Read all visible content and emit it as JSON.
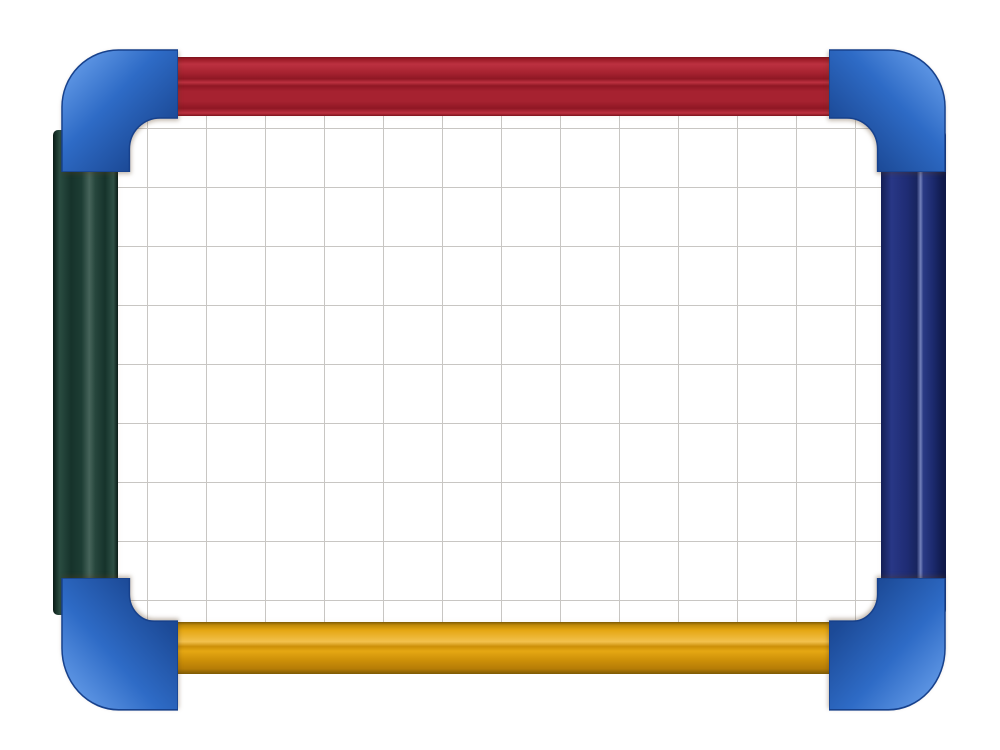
{
  "scene": {
    "type": "product-photograph",
    "description": "A children's magnetic dry-wipe whiteboard photographed on a plain white background. The frame is made of brightly coloured plastic rails: a ribbed red rail across the top, a very dark green rail on the left, a dark navy-blue rail on the right and a golden-yellow ribbed rail along the bottom. The four rails are joined by rounded bright-blue corner caps. The white writing surface is printed with a light grey square grid.",
    "objects": [
      "whiteboard writing surface with square grid",
      "red top frame rail",
      "dark green left frame rail",
      "navy blue right frame rail",
      "golden yellow bottom frame rail",
      "four rounded bright blue corner caps"
    ]
  },
  "board": {
    "grid_cell_px": 59,
    "grid_offset_x_px": 35,
    "grid_offset_y_px": 18,
    "grid_columns_visible": 13,
    "grid_rows_visible": 9
  },
  "colors": {
    "background": "#ffffff",
    "surface": "#ffffff",
    "grid_line": "#c8c6c3",
    "red_base": "#a62230",
    "red_light": "#bc3140",
    "red_groove": "#8f1724",
    "red_dark": "#7c121c",
    "yellow_base": "#e5a713",
    "yellow_light": "#f2c14d",
    "yellow_groove": "#cc8f08",
    "yellow_dark": "#7d5a04",
    "green_base": "#16332b",
    "green_light": "#46645a",
    "green_dark": "#0a1b16",
    "navy_base": "#1f2c74",
    "navy_light": "#7381bb",
    "navy_dark": "#0e1745",
    "corner_light": "#5b93e2",
    "corner_base": "#2e6bc6",
    "corner_dark": "#1c4a97",
    "corner_edge": "#17418c"
  }
}
